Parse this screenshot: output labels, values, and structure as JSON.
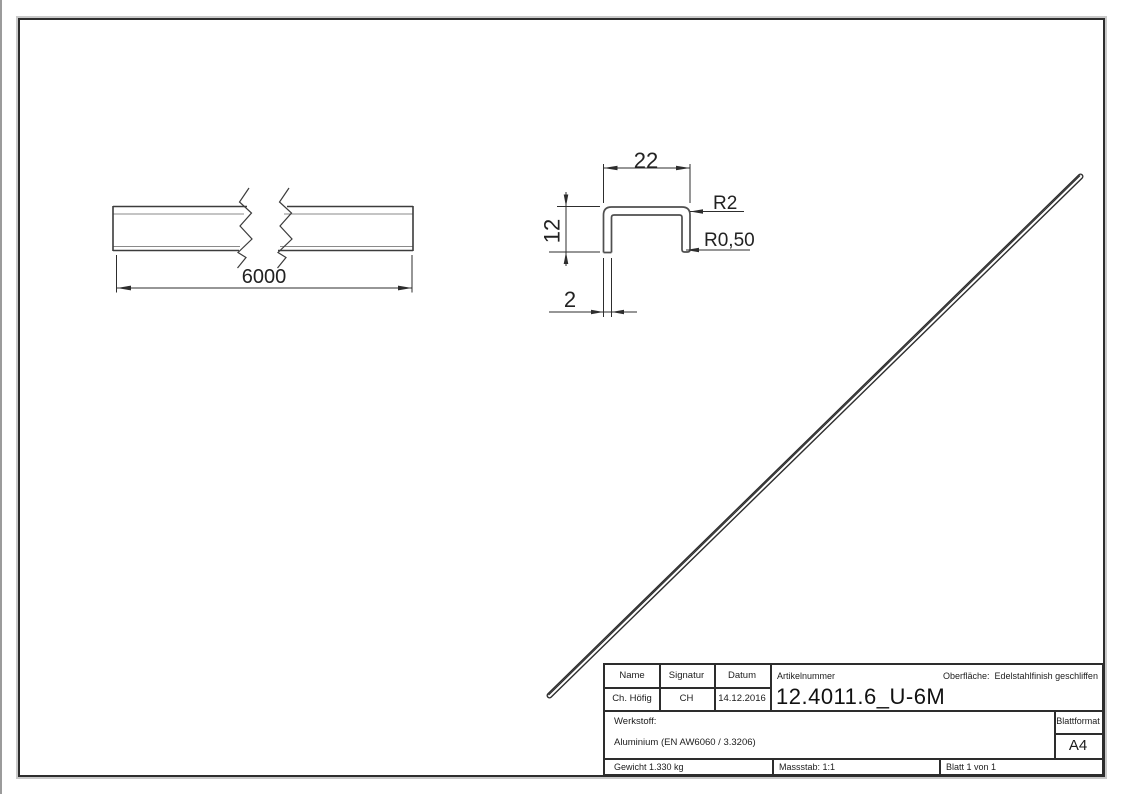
{
  "drawing": {
    "dims": {
      "length": "6000",
      "width": "22",
      "height": "12",
      "thickness": "2",
      "radius_outer": "R2",
      "radius_inner": "R0,50"
    },
    "title_block": {
      "col_name": "Name",
      "col_signatur": "Signatur",
      "col_datum": "Datum",
      "artikelnummer_label": "Artikelnummer",
      "artikelnummer": "12.4011.6_U-6M",
      "oberflaeche_label": "Oberfläche:",
      "oberflaeche_value": "Edelstahlfinish geschliffen",
      "name": "Ch. Höfig",
      "signatur": "CH",
      "datum": "14.12.2016",
      "werkstoff_label": "Werkstoff:",
      "werkstoff_value": "Aluminium (EN AW6060 / 3.3206)",
      "blattformat_label": "Blattformat",
      "blattformat_value": "A4",
      "gewicht": "Gewicht 1.330 kg",
      "massstab": "Massstab: 1:1",
      "blatt": "Blatt 1 von 1"
    }
  }
}
